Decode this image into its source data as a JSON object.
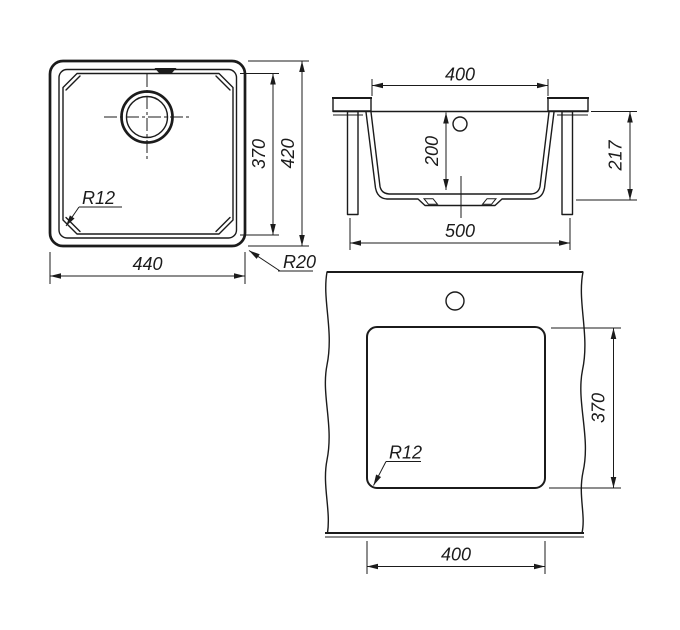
{
  "drawing": {
    "description": "Undermount square sink technical drawing with three views",
    "colors": {
      "background": "#ffffff",
      "line": "#1b1b1b"
    },
    "top_view": {
      "width": "440",
      "bowl_height": "370",
      "overall_height": "420",
      "bowl_corner_radius": "R12",
      "outer_corner_radius": "R20"
    },
    "section_view": {
      "bowl_top_width": "400",
      "bowl_depth": "200",
      "overall_height": "217",
      "base_width": "500"
    },
    "cutout_view": {
      "cutout_width": "400",
      "cutout_height": "370",
      "corner_radius": "R12"
    }
  }
}
